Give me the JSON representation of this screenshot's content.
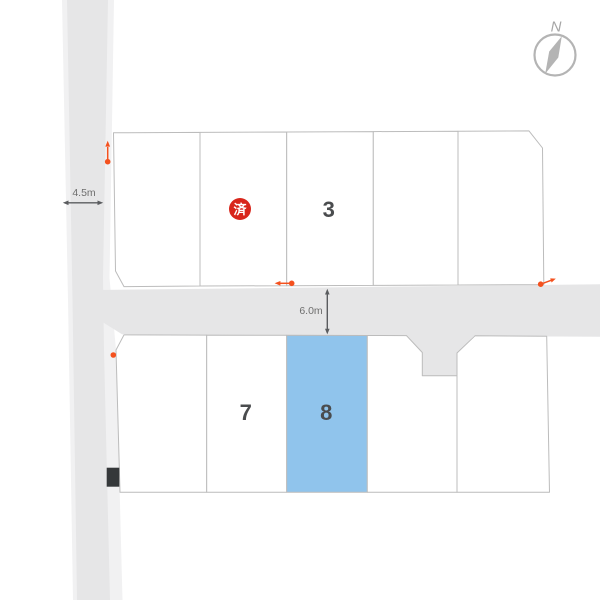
{
  "compass": {
    "north_label": "N"
  },
  "dimensions": {
    "left_road_width": "4.5m",
    "main_road_width": "6.0m"
  },
  "lots": {
    "lot_3_label": "3",
    "lot_7_label": "7",
    "lot_8_label": "8",
    "sold_stamp": "済"
  },
  "colors": {
    "road_gray": "#e6e6e7",
    "road_edge_light": "#f1f1f2",
    "lot_border_gray": "#bcbcbc",
    "highlight_blue": "#90c4ec",
    "sold_red": "#d8261b",
    "marker_orange": "#f4511e",
    "dimension_arrow_gray": "#5a5c5f",
    "utility_marker_dark": "#35383a",
    "compass_gray": "#b4b4b4"
  }
}
